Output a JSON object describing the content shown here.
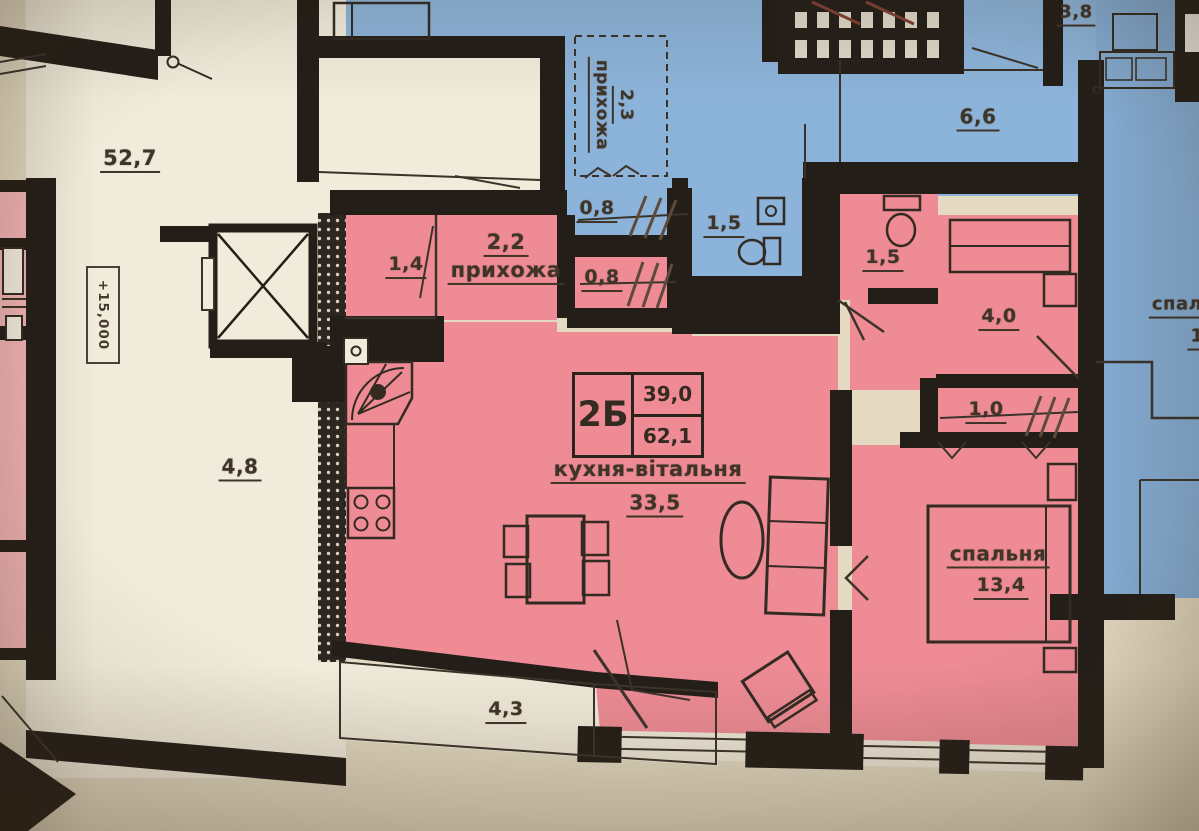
{
  "stamp": {
    "code": "2Б",
    "upper_area": "39,0",
    "total_area": "62,1"
  },
  "apartment": {
    "kitchen_living_name": "кухня-вітальня",
    "kitchen_living_area": "33,5",
    "bedroom_name": "спальня",
    "bedroom_area": "13,4",
    "hall_name": "прихожа",
    "hall_area": "2,2",
    "room_small_area": "1,4",
    "closet_area": "0,8",
    "bathroom_area": "1,5",
    "wardrobe_room_area": "4,0",
    "closet2_area": "1,0",
    "balcony_area": "4,3"
  },
  "common": {
    "lobby_area": "52,7",
    "corridor_area": "4,8",
    "elevation_mark": "+15,000"
  },
  "neighbors": {
    "hall_name": "прихожа",
    "hall_area": "2,3",
    "closet_area": "0,8",
    "bathroom_area": "1,5",
    "stair_room_area": "3,8",
    "hall2_area": "6,6",
    "right_room_name_partial": "спаль",
    "right_room_area_partial": "1"
  },
  "colors": {
    "unit": "#ee8b95",
    "unit_light": "#f4b6b6",
    "neighbor": "#8cb3d9",
    "common": "#f1ebdb",
    "outside": "#e4dac2",
    "wall": "#231e18",
    "ink": "#3f3428"
  }
}
